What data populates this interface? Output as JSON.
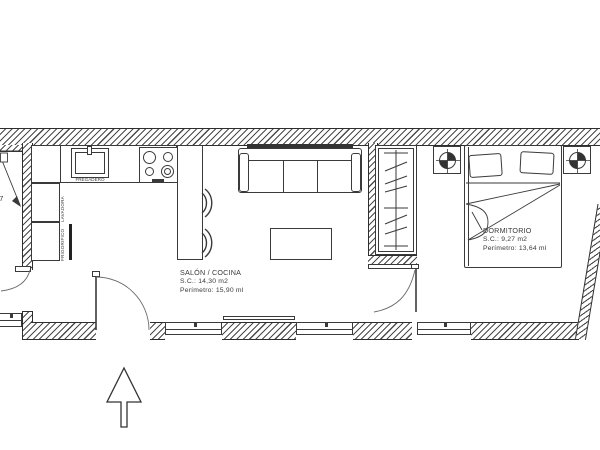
{
  "plan": {
    "rooms": {
      "salon": {
        "name": "SALÓN / COCINA",
        "area": "S.C.: 14,30 m2",
        "perimeter": "Perímetro: 15,90 ml"
      },
      "dormitorio": {
        "name": "DORMITORIO",
        "area": "S.C.: 9,27 m2",
        "perimeter": "Perímetro: 13,64 ml"
      }
    },
    "kitchen": {
      "sink_label": "FREGADERO",
      "washer_label": "LAVADORA",
      "fridge_label": "FRIGORIFICO"
    },
    "dimensions": {
      "left_width": "0,7"
    },
    "colors": {
      "wall_line": "#2e2e2e",
      "drawing_line": "#3a3a3a",
      "background": "#ffffff"
    }
  }
}
